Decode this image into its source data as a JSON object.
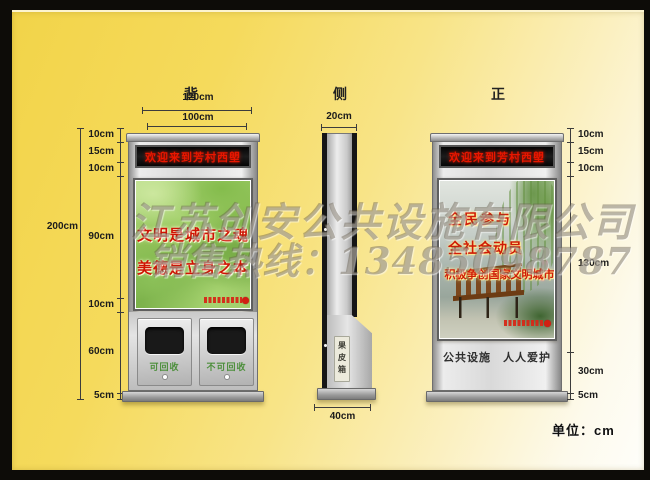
{
  "unit_note": "单位：cm",
  "watermark": {
    "line1": "江苏创安公共设施有限公司",
    "line2": "销售热线：13485098787"
  },
  "views": {
    "back": {
      "label": "背",
      "dim_outer_width": "120cm",
      "dim_inner_width": "100cm",
      "dim_total_height": "200cm",
      "dims_left": [
        "10cm",
        "15cm",
        "10cm",
        "90cm",
        "10cm",
        "60cm",
        "5cm"
      ],
      "led_text": "欢迎来到芳村西塱",
      "poster_lines": [
        "文明是城市之魂",
        "美德是立身之本"
      ],
      "bin_labels": [
        "可回收",
        "不可回收"
      ]
    },
    "side": {
      "label": "侧",
      "dim_top_width": "20cm",
      "dim_bottom_width": "40cm",
      "bin_vertical_label": "果皮箱"
    },
    "front": {
      "label": "正",
      "led_text": "欢迎来到芳村西塱",
      "poster_lines": [
        "全民参与",
        "全社会动员",
        "积极争创国家文明城市"
      ],
      "footer_text": "公共设施　人人爱护",
      "dims_right": [
        "10cm",
        "15cm",
        "10cm",
        "130cm",
        "30cm",
        "5cm"
      ]
    }
  },
  "colors": {
    "page_yellow": "#f5da5c",
    "led_red": "#e81700",
    "slogan_red": "#cf1303",
    "bin_label_green": "#4d8f3c",
    "metal_silver": "#d9d9d9",
    "frame_black": "#0d0c08"
  }
}
